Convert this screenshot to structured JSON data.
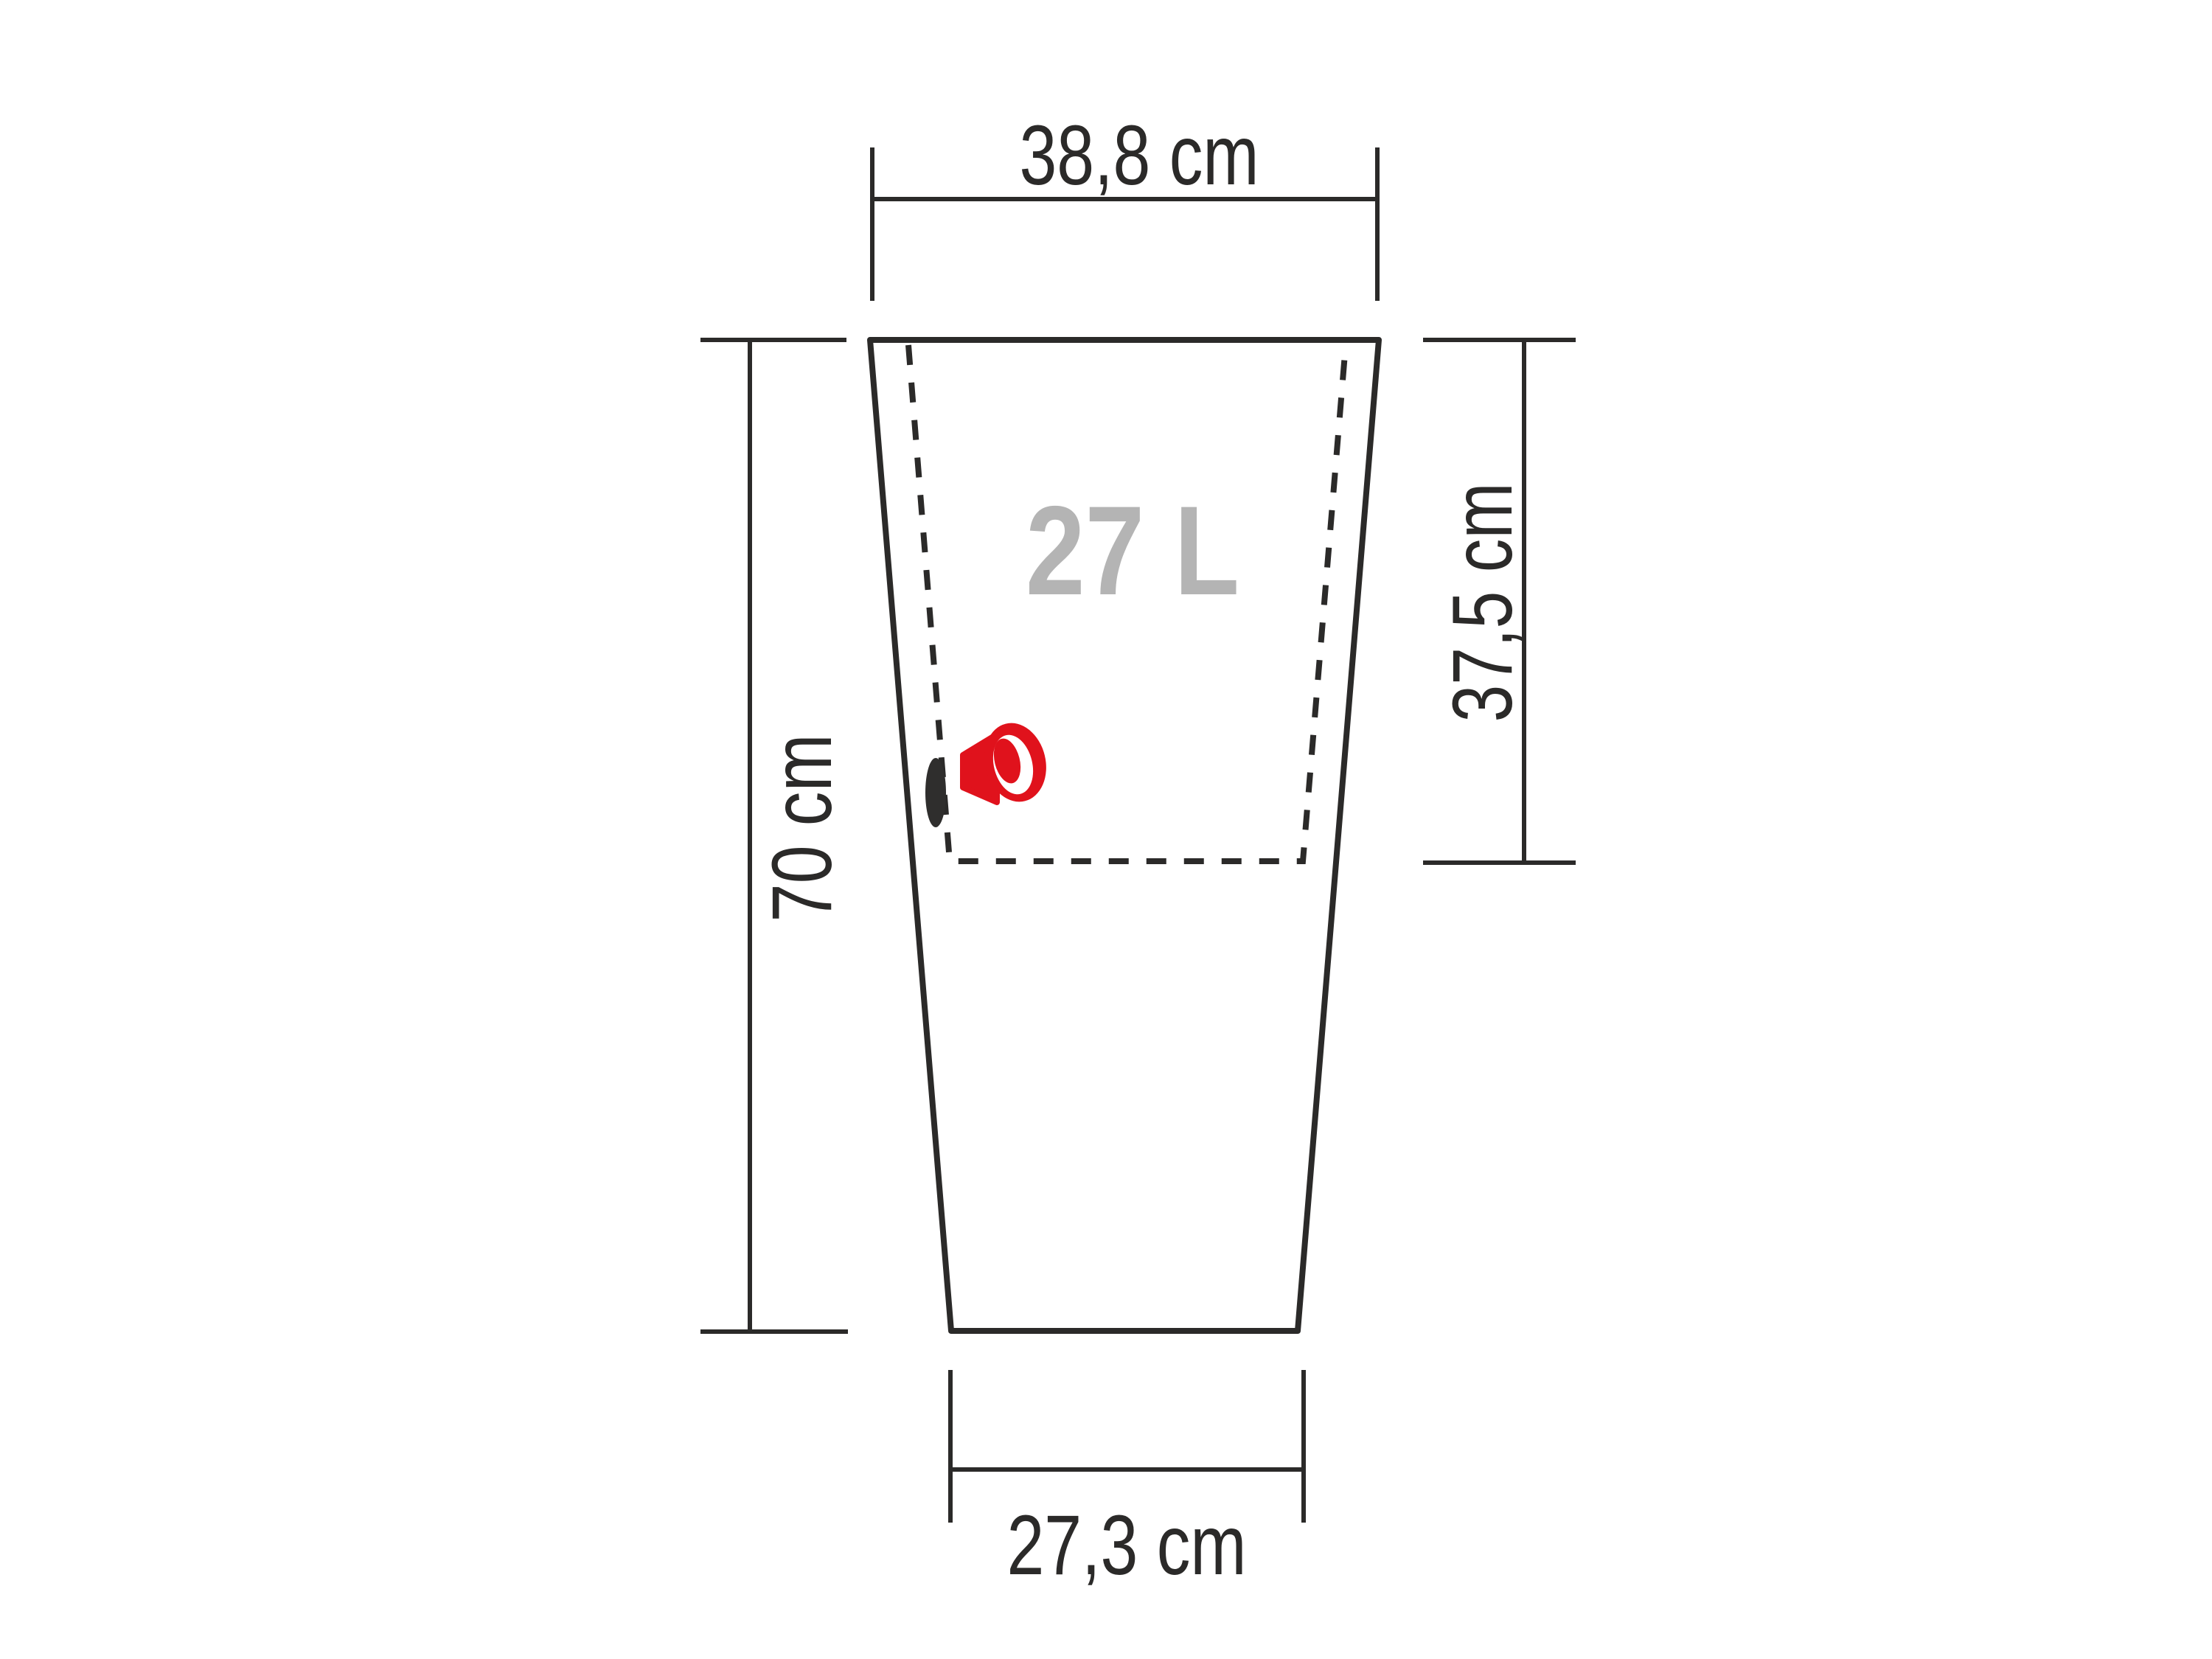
{
  "labels": {
    "top_width": "38,8 cm",
    "height": "70 cm",
    "inner_depth": "37,5 cm",
    "bottom_width": "27,3 cm",
    "capacity": "27 L"
  },
  "colors": {
    "line": "#2b2a29",
    "capacity_text": "#b4b4b4",
    "plug_red": "#e0121c",
    "drain_hole_dark": "#2f2e2d",
    "background": "#ffffff"
  }
}
